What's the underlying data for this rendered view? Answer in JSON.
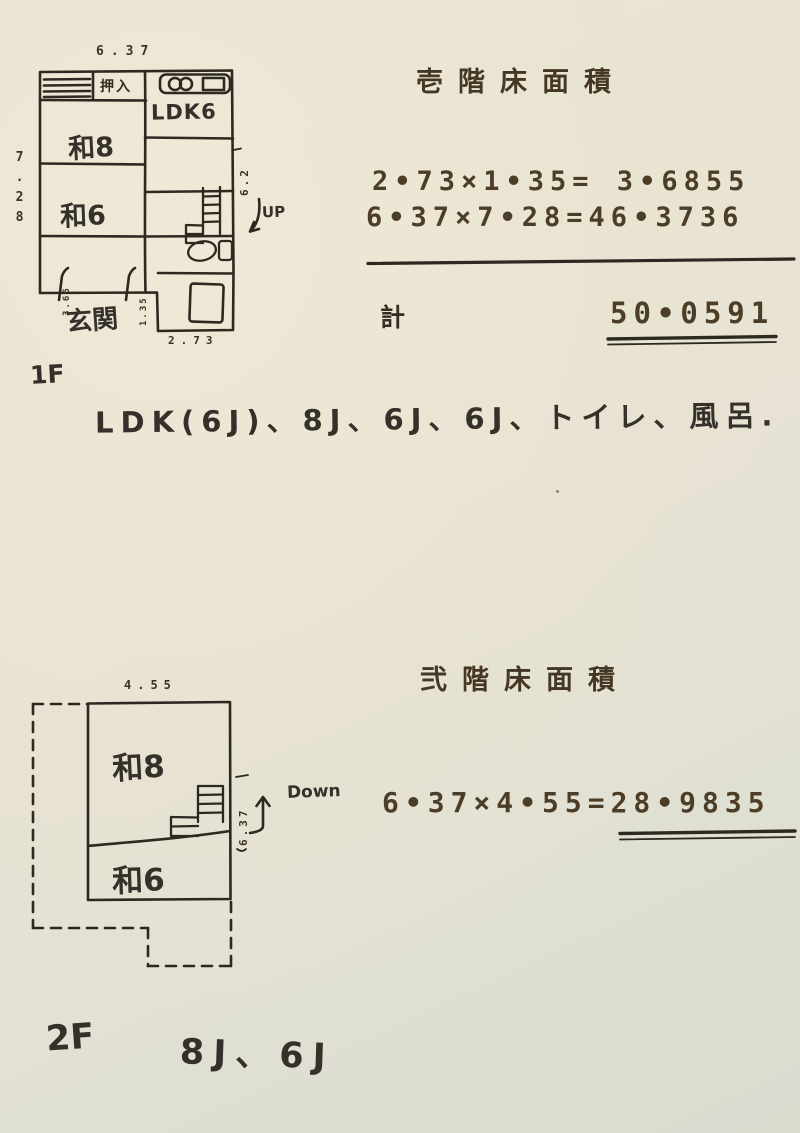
{
  "colors": {
    "paper": "#e9e3d3",
    "typed_ink": "#4a3b26",
    "plan_ink": "#2d2820",
    "hand_ink": "#35302a"
  },
  "floor1": {
    "title": "壱階床面積",
    "equations": {
      "line1": "2•73×1•35= 3•6855",
      "line2": "6•37×7•28=46•3736"
    },
    "total": {
      "label": "計",
      "value": "50•0591"
    },
    "plan": {
      "dim_top": "6.37",
      "dim_left": "7.28",
      "dim_right": "6.2",
      "dim_bottom_left": "3.66",
      "dim_ext_height": "1.35",
      "dim_ext_width": "2.73",
      "room_oshiire": "押入",
      "room_ldk": "LDK6",
      "room_wa8": "和8",
      "room_wa6": "和6",
      "room_genkan": "玄関",
      "stairs_label": "UP"
    },
    "floor_label": "1F",
    "rooms_note": "LDK(6J)、8J、6J、6J、トイレ、風呂."
  },
  "floor2": {
    "title": "弐階床面積",
    "equation": "6•37×4•55=28•9835",
    "plan": {
      "dim_top": "4.55",
      "dim_right": "6.37",
      "room_wa8": "和8",
      "room_wa6": "和6",
      "stairs_label": "Down"
    },
    "floor_label": "2F",
    "rooms_note": "8J、6J"
  }
}
